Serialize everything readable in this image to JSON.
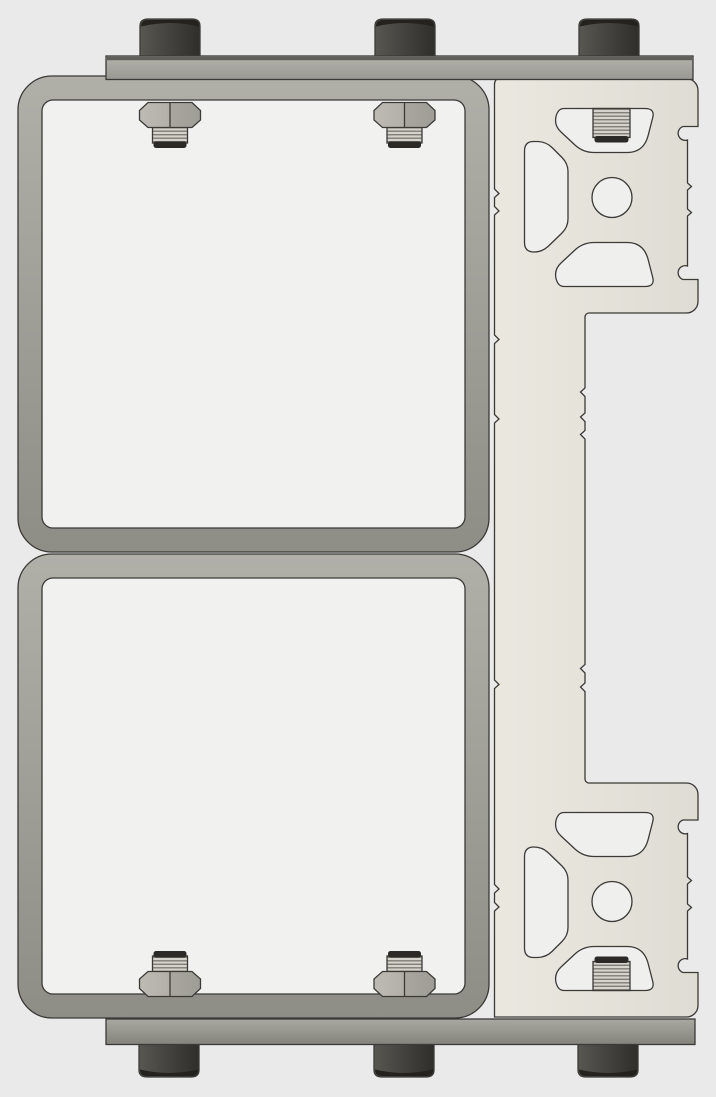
{
  "canvas": {
    "width": 716,
    "height": 1097
  },
  "scene": {
    "title": "CAD assembly render",
    "description": "Orthographic CAD render of a bolted assembly: two rounded-square tube frames stacked vertically between a top and a bottom mounting plate, fastened with three socket-head bolts per plate and hex nuts on threaded studs; a T-slot aluminum extrusion rail profile with X-pattern slot cutouts, center bores and threaded studs runs along the right side."
  },
  "parts": {
    "upper_frame": "Upper rounded-square tube frame",
    "lower_frame": "Lower rounded-square tube frame",
    "top_plate": "Top mounting plate",
    "bottom_plate": "Bottom mounting plate",
    "extrusion_rail": "T-slot extrusion rail profile with slot cutouts and center bores",
    "bolts": "Socket-head bolt heads: 3 above top plate, 3 below bottom plate",
    "nuts": "Hex nuts on threaded studs: 2 under top plate, 2 above bottom plate",
    "extrusion_studs": "Threaded studs seated in extrusion slots: 1 top block, 1 bottom block"
  },
  "colors": {
    "background": "#eaeaea",
    "frame_interior": "#f1f1f0",
    "cutout_fill": "#efefed",
    "outline": "#3b3a37",
    "tube_light": "#b0afa8",
    "tube_dark": "#8e8d86",
    "plate_light": "#b3b2ab",
    "plate_dark": "#999892",
    "plate2_light": "#a9a8a1",
    "plate2_dark": "#84837c",
    "plate_top_edge": "#5f5e58",
    "extrusion_light": "#eae8df",
    "extrusion_dark": "#dedcd3",
    "bolt_light": "#585751",
    "bolt_mid": "#454440",
    "bolt_dark": "#2f2e2a",
    "bolt_cap": "#23221e",
    "nut_light": "#bdbbb3",
    "nut_mid_left": "#b2b0a8",
    "nut_mid_right": "#a8a69f",
    "nut_dark": "#9e9d96",
    "thread_light": "#d5d3cb",
    "thread_dark": "#7f7e77",
    "stud_cap": "#2b2a26"
  }
}
